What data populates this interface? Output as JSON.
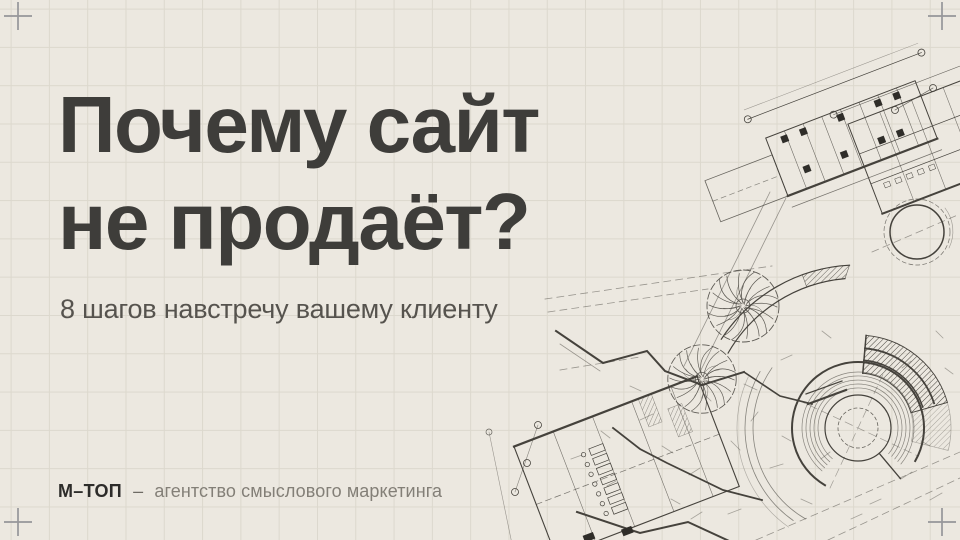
{
  "slide": {
    "title": {
      "line1": "Почему сайт",
      "line2": "не продаёт?"
    },
    "subtitle": "8 шагов навстречу вашему клиенту",
    "footer": {
      "brand": "М–ТОП",
      "separator": "–",
      "description": "агентство смыслового маркетинга"
    }
  },
  "decor": {
    "blueprint_description": "architectural floor plan with amphitheater, trees and dimension lines",
    "corner_marks": "crosshair registration marks in all four corners"
  },
  "colors": {
    "background": "#ECE8E0",
    "grid_line": "#DCD8CD",
    "title_text": "#3E3D3A",
    "subtitle_text": "#56534E",
    "footer_brand": "#2D2C2A",
    "footer_text": "#837F77",
    "blueprint_ink": "#45423C",
    "corner_mark": "#96969A"
  }
}
